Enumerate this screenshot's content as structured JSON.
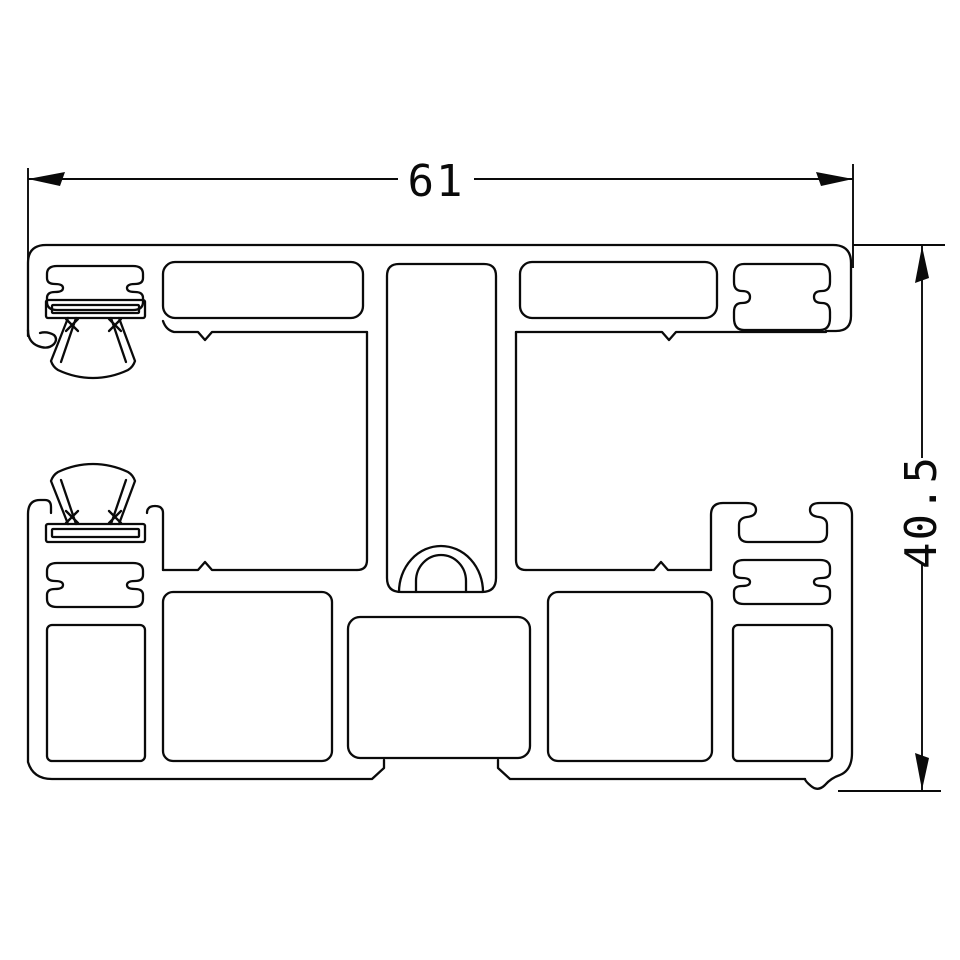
{
  "drawing": {
    "kind": "CAD technical drawing - extruded profile cross-section",
    "background_color": "#ffffff",
    "line_color": "#0a0a0a",
    "dimensions": {
      "width": {
        "label": "61",
        "orientation": "horizontal",
        "position": "top"
      },
      "height": {
        "label": "40.5",
        "orientation": "vertical",
        "position": "right"
      }
    },
    "features": [
      "top bar with two long hollow chambers",
      "four gasket grooves",
      "two brush seals with fan bristles",
      "central stem slot with screw boss",
      "five bottom hollow chambers",
      "bottom drip notch"
    ]
  }
}
